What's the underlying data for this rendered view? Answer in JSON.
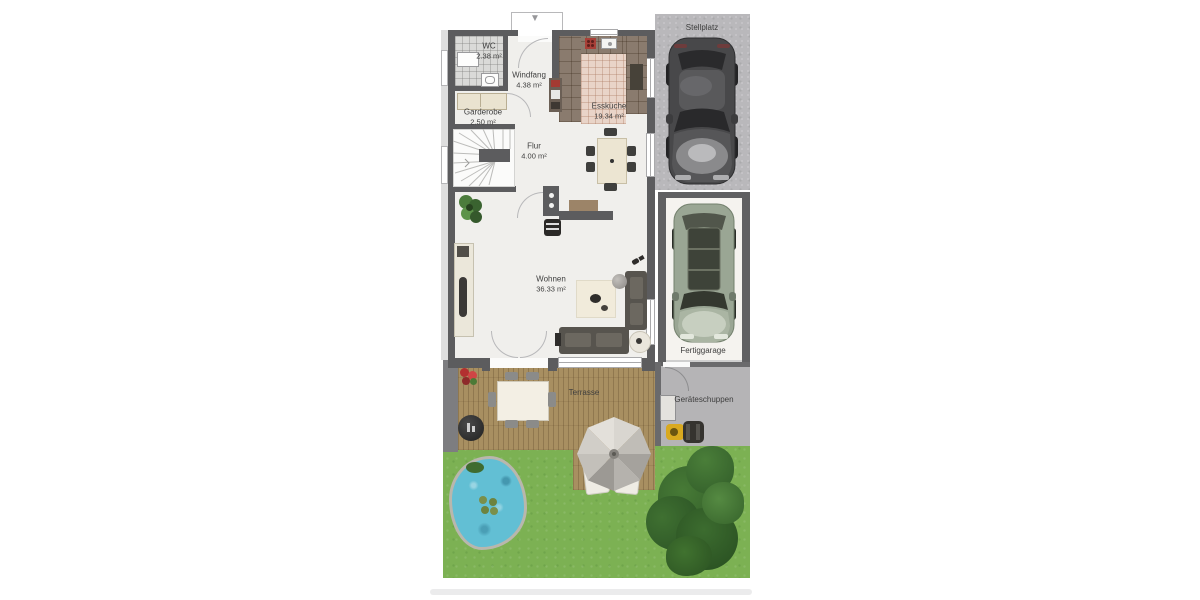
{
  "rooms": {
    "wc": {
      "name": "WC",
      "area": "2.38 m²"
    },
    "windfang": {
      "name": "Windfang",
      "area": "4.38 m²"
    },
    "garderobe": {
      "name": "Garderobe",
      "area": "2.50 m²"
    },
    "flur": {
      "name": "Flur",
      "area": "4.00 m²"
    },
    "esskueche": {
      "name": "Essküche",
      "area": "19.34 m²"
    },
    "wohnen": {
      "name": "Wohnen",
      "area": "36.33 m²"
    }
  },
  "outdoor": {
    "stellplatz": {
      "name": "Stellplatz"
    },
    "fertiggarage": {
      "name": "Fertiggarage"
    },
    "geraeteschuppen": {
      "name": "Geräteschuppen"
    },
    "terrasse": {
      "name": "Terrasse"
    }
  },
  "icons": {
    "entrance_arrow": "▼"
  },
  "colors": {
    "wall": "#5c5c5e",
    "floor": "#f0efec",
    "wcTile": "#dadad8",
    "kitchenTile": "#e9d4c8",
    "counter": "#8a7b6e",
    "deck": "#a88f61",
    "grass": "#7cb153",
    "water": "#62bfd4",
    "paving": "#b9b8bb",
    "garageWall": "#606062",
    "garageFloor": "#f5f3ef",
    "shedFloor": "#b5b4b6",
    "sofa": "#57544e",
    "cushion": "#6c6860",
    "cream": "#ece5d2",
    "carDark": "#48484a",
    "carSilver": "#9aa694",
    "mowerYellow": "#d9a91f",
    "tree": "#35622c",
    "label": "#3e3e3e"
  }
}
